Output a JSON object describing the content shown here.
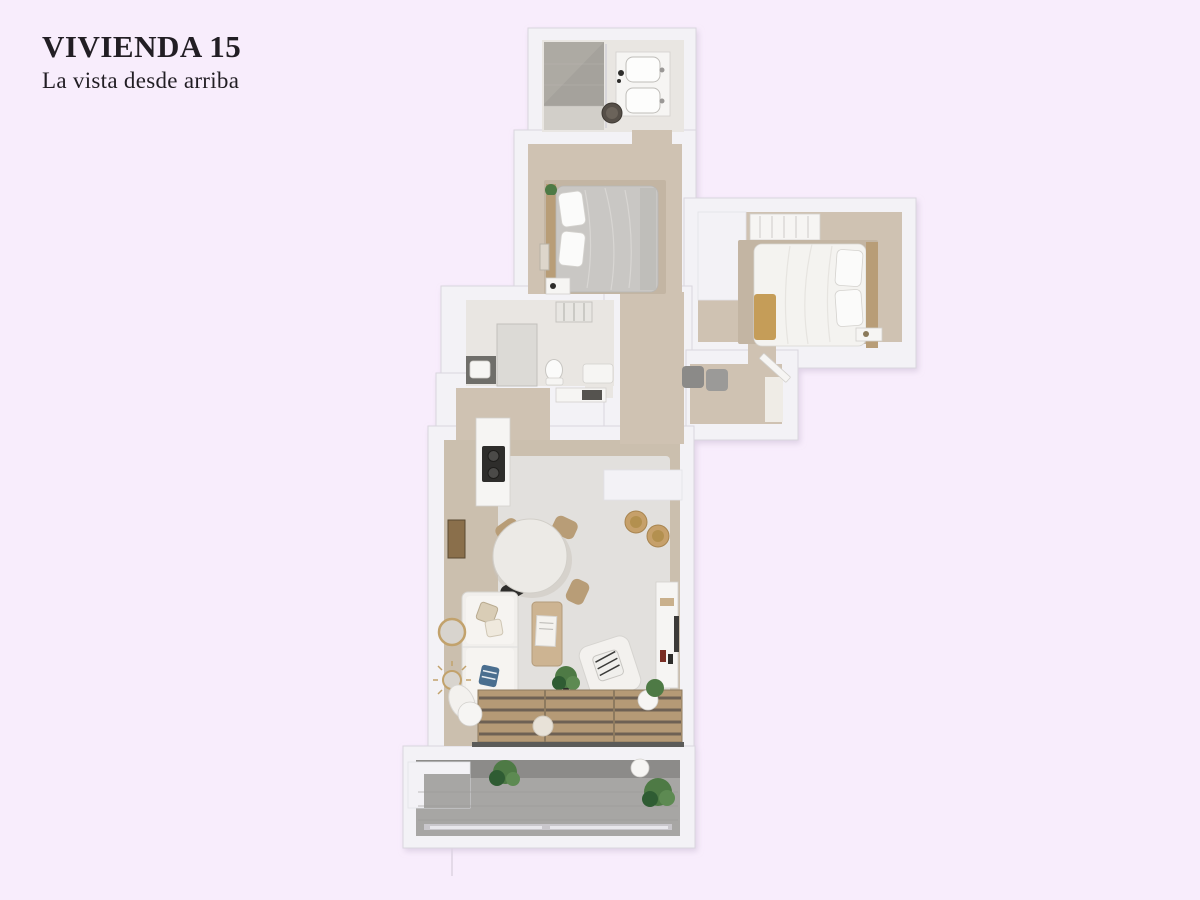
{
  "header": {
    "title": "VIVIENDA 15",
    "subtitle": "La vista desde arriba"
  },
  "palette": {
    "bg": "#f8edfc",
    "titleColor": "#221e24",
    "wall": "#f3f2f6",
    "wallEdge": "#d9d6de",
    "wallShade": "#e3e1e8",
    "wood": "#cfc2b2",
    "woodDark": "#c3b5a3",
    "bathFloor": "#e9e6e2",
    "tile": "#a5a29c",
    "rug": "#e2e0dd",
    "livingWood": "#cbbfae",
    "terrace": "#a7a6a4",
    "terraceShade": "#8c8b89",
    "duvetGray": "#c9c7c4",
    "white": "#f6f5f3",
    "tan": "#b89d77",
    "gold": "#c59d58",
    "plant": "#4e7a45",
    "plantDark": "#2f5c33",
    "dark": "#2e2d2b",
    "gray": "#8b8a88"
  }
}
